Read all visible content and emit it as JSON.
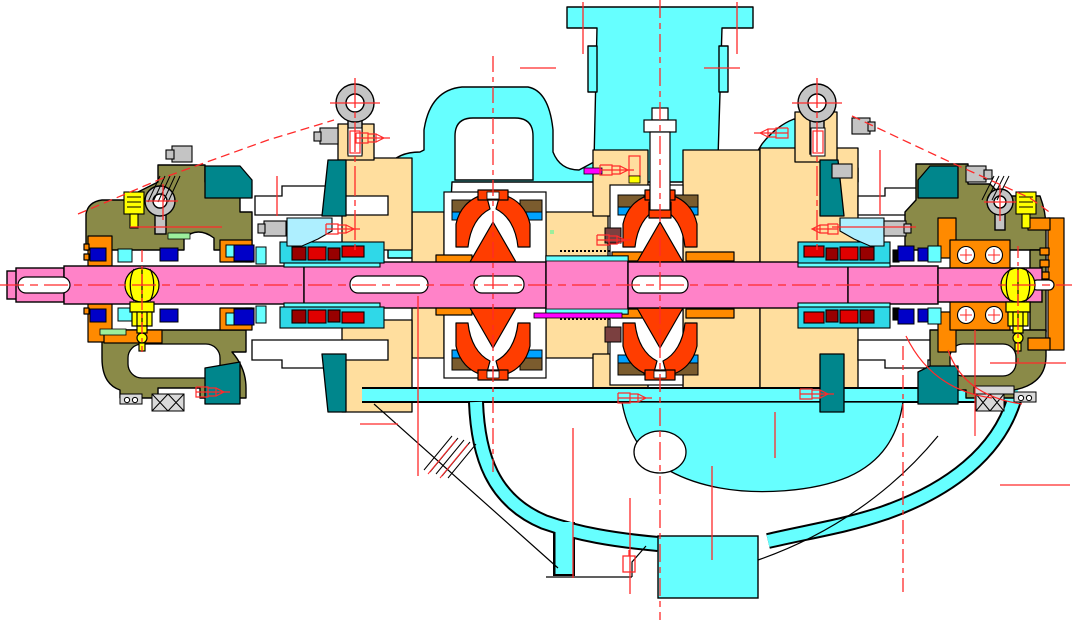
{
  "image_type": "engineering-cad-cross-section",
  "subject": "multistage centrifugal pump sectional drawing",
  "colors": {
    "casing": "#66FFFF",
    "gland": "#AEEFFF",
    "cartridge": "#2FD8E8",
    "diffuser": "#FFDE9E",
    "housing": "#8A8A48",
    "bracket": "#00868C",
    "cover": "#FF8A00",
    "impeller": "#FF3D00",
    "shaft": "#FF82C8",
    "bearing": "#FFFF00",
    "wearRing": "#7B5C2E",
    "balanceBush": "#7B4040",
    "ringBlue": "#00A2FF",
    "glandBolt": "#0000C8",
    "sealRed": "#E00000",
    "sealDark": "#990000",
    "hardware": "#C4C4C4",
    "hardwareDark": "#8A8A8A",
    "pad": "#D9D9D9",
    "gasket": "#9CEE9C",
    "marker": "#FF00FF",
    "centerline": "#FF2A2A",
    "white": "#FFFFFF",
    "black": "#000000"
  }
}
